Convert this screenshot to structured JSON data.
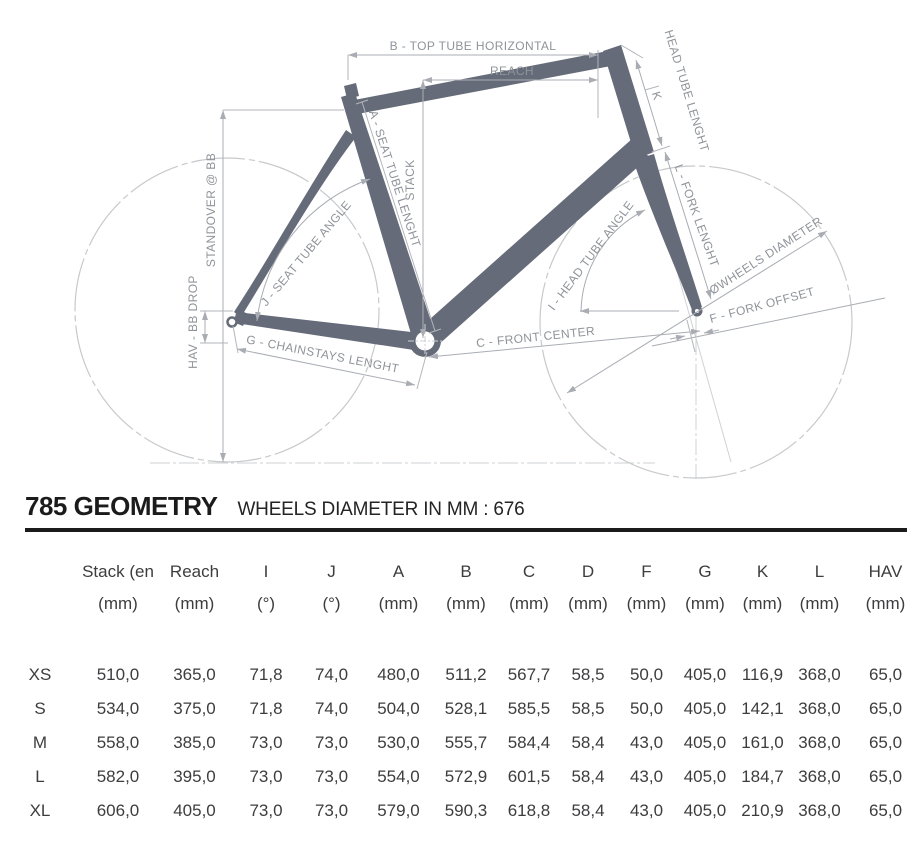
{
  "diagram": {
    "labels": {
      "top_tube": "B - TOP TUBE HORIZONTAL",
      "reach": "REACH",
      "stack": "STACK",
      "seat_tube_length": "A - SEAT TUBE LENGHT",
      "standover": "STANDOVER @ BB",
      "bb_drop": "HAV - BB DROP",
      "seat_tube_angle": "J - SEAT TUBE ANGLE",
      "chainstays": "G - CHAINSTAYS LENGHT",
      "head_tube_length": "HEAD TUBE LENGHT",
      "k": "K",
      "fork_length": "L - FORK LENGHT",
      "head_tube_angle": "I - HEAD TUBE ANGLE",
      "front_center": "C - FRONT CENTER",
      "wheels_diameter": "ØWHEELS DIAMETER",
      "fork_offset": "F - FORK OFFSET"
    },
    "colors": {
      "frame": "#656b78",
      "dim_line": "#a9adb3",
      "label": "#8f949a",
      "wheel": "#c7c9cc"
    }
  },
  "header": {
    "title": "785 GEOMETRY",
    "subtitle": "WHEELS DIAMETER IN MM : 676"
  },
  "table": {
    "columns": [
      {
        "label": "Stack (en",
        "unit": "(mm)"
      },
      {
        "label": "Reach",
        "unit": "(mm)"
      },
      {
        "label": "I",
        "unit": "(°)"
      },
      {
        "label": "J",
        "unit": "(°)"
      },
      {
        "label": "A",
        "unit": "(mm)"
      },
      {
        "label": "B",
        "unit": "(mm)"
      },
      {
        "label": "C",
        "unit": "(mm)"
      },
      {
        "label": "D",
        "unit": "(mm)"
      },
      {
        "label": "F",
        "unit": "(mm)"
      },
      {
        "label": "G",
        "unit": "(mm)"
      },
      {
        "label": "K",
        "unit": "(mm)"
      },
      {
        "label": "L",
        "unit": "(mm)"
      },
      {
        "label": "HAV",
        "unit": "(mm)"
      }
    ],
    "rows": [
      {
        "size": "XS",
        "values": [
          "510,0",
          "365,0",
          "71,8",
          "74,0",
          "480,0",
          "511,2",
          "567,7",
          "58,5",
          "50,0",
          "405,0",
          "116,9",
          "368,0",
          "65,0"
        ]
      },
      {
        "size": "S",
        "values": [
          "534,0",
          "375,0",
          "71,8",
          "74,0",
          "504,0",
          "528,1",
          "585,5",
          "58,5",
          "50,0",
          "405,0",
          "142,1",
          "368,0",
          "65,0"
        ]
      },
      {
        "size": "M",
        "values": [
          "558,0",
          "385,0",
          "73,0",
          "73,0",
          "530,0",
          "555,7",
          "584,4",
          "58,4",
          "43,0",
          "405,0",
          "161,0",
          "368,0",
          "65,0"
        ]
      },
      {
        "size": "L",
        "values": [
          "582,0",
          "395,0",
          "73,0",
          "73,0",
          "554,0",
          "572,9",
          "601,5",
          "58,4",
          "43,0",
          "405,0",
          "184,7",
          "368,0",
          "65,0"
        ]
      },
      {
        "size": "XL",
        "values": [
          "606,0",
          "405,0",
          "73,0",
          "73,0",
          "579,0",
          "590,3",
          "618,8",
          "58,4",
          "43,0",
          "405,0",
          "210,9",
          "368,0",
          "65,0"
        ]
      }
    ]
  }
}
